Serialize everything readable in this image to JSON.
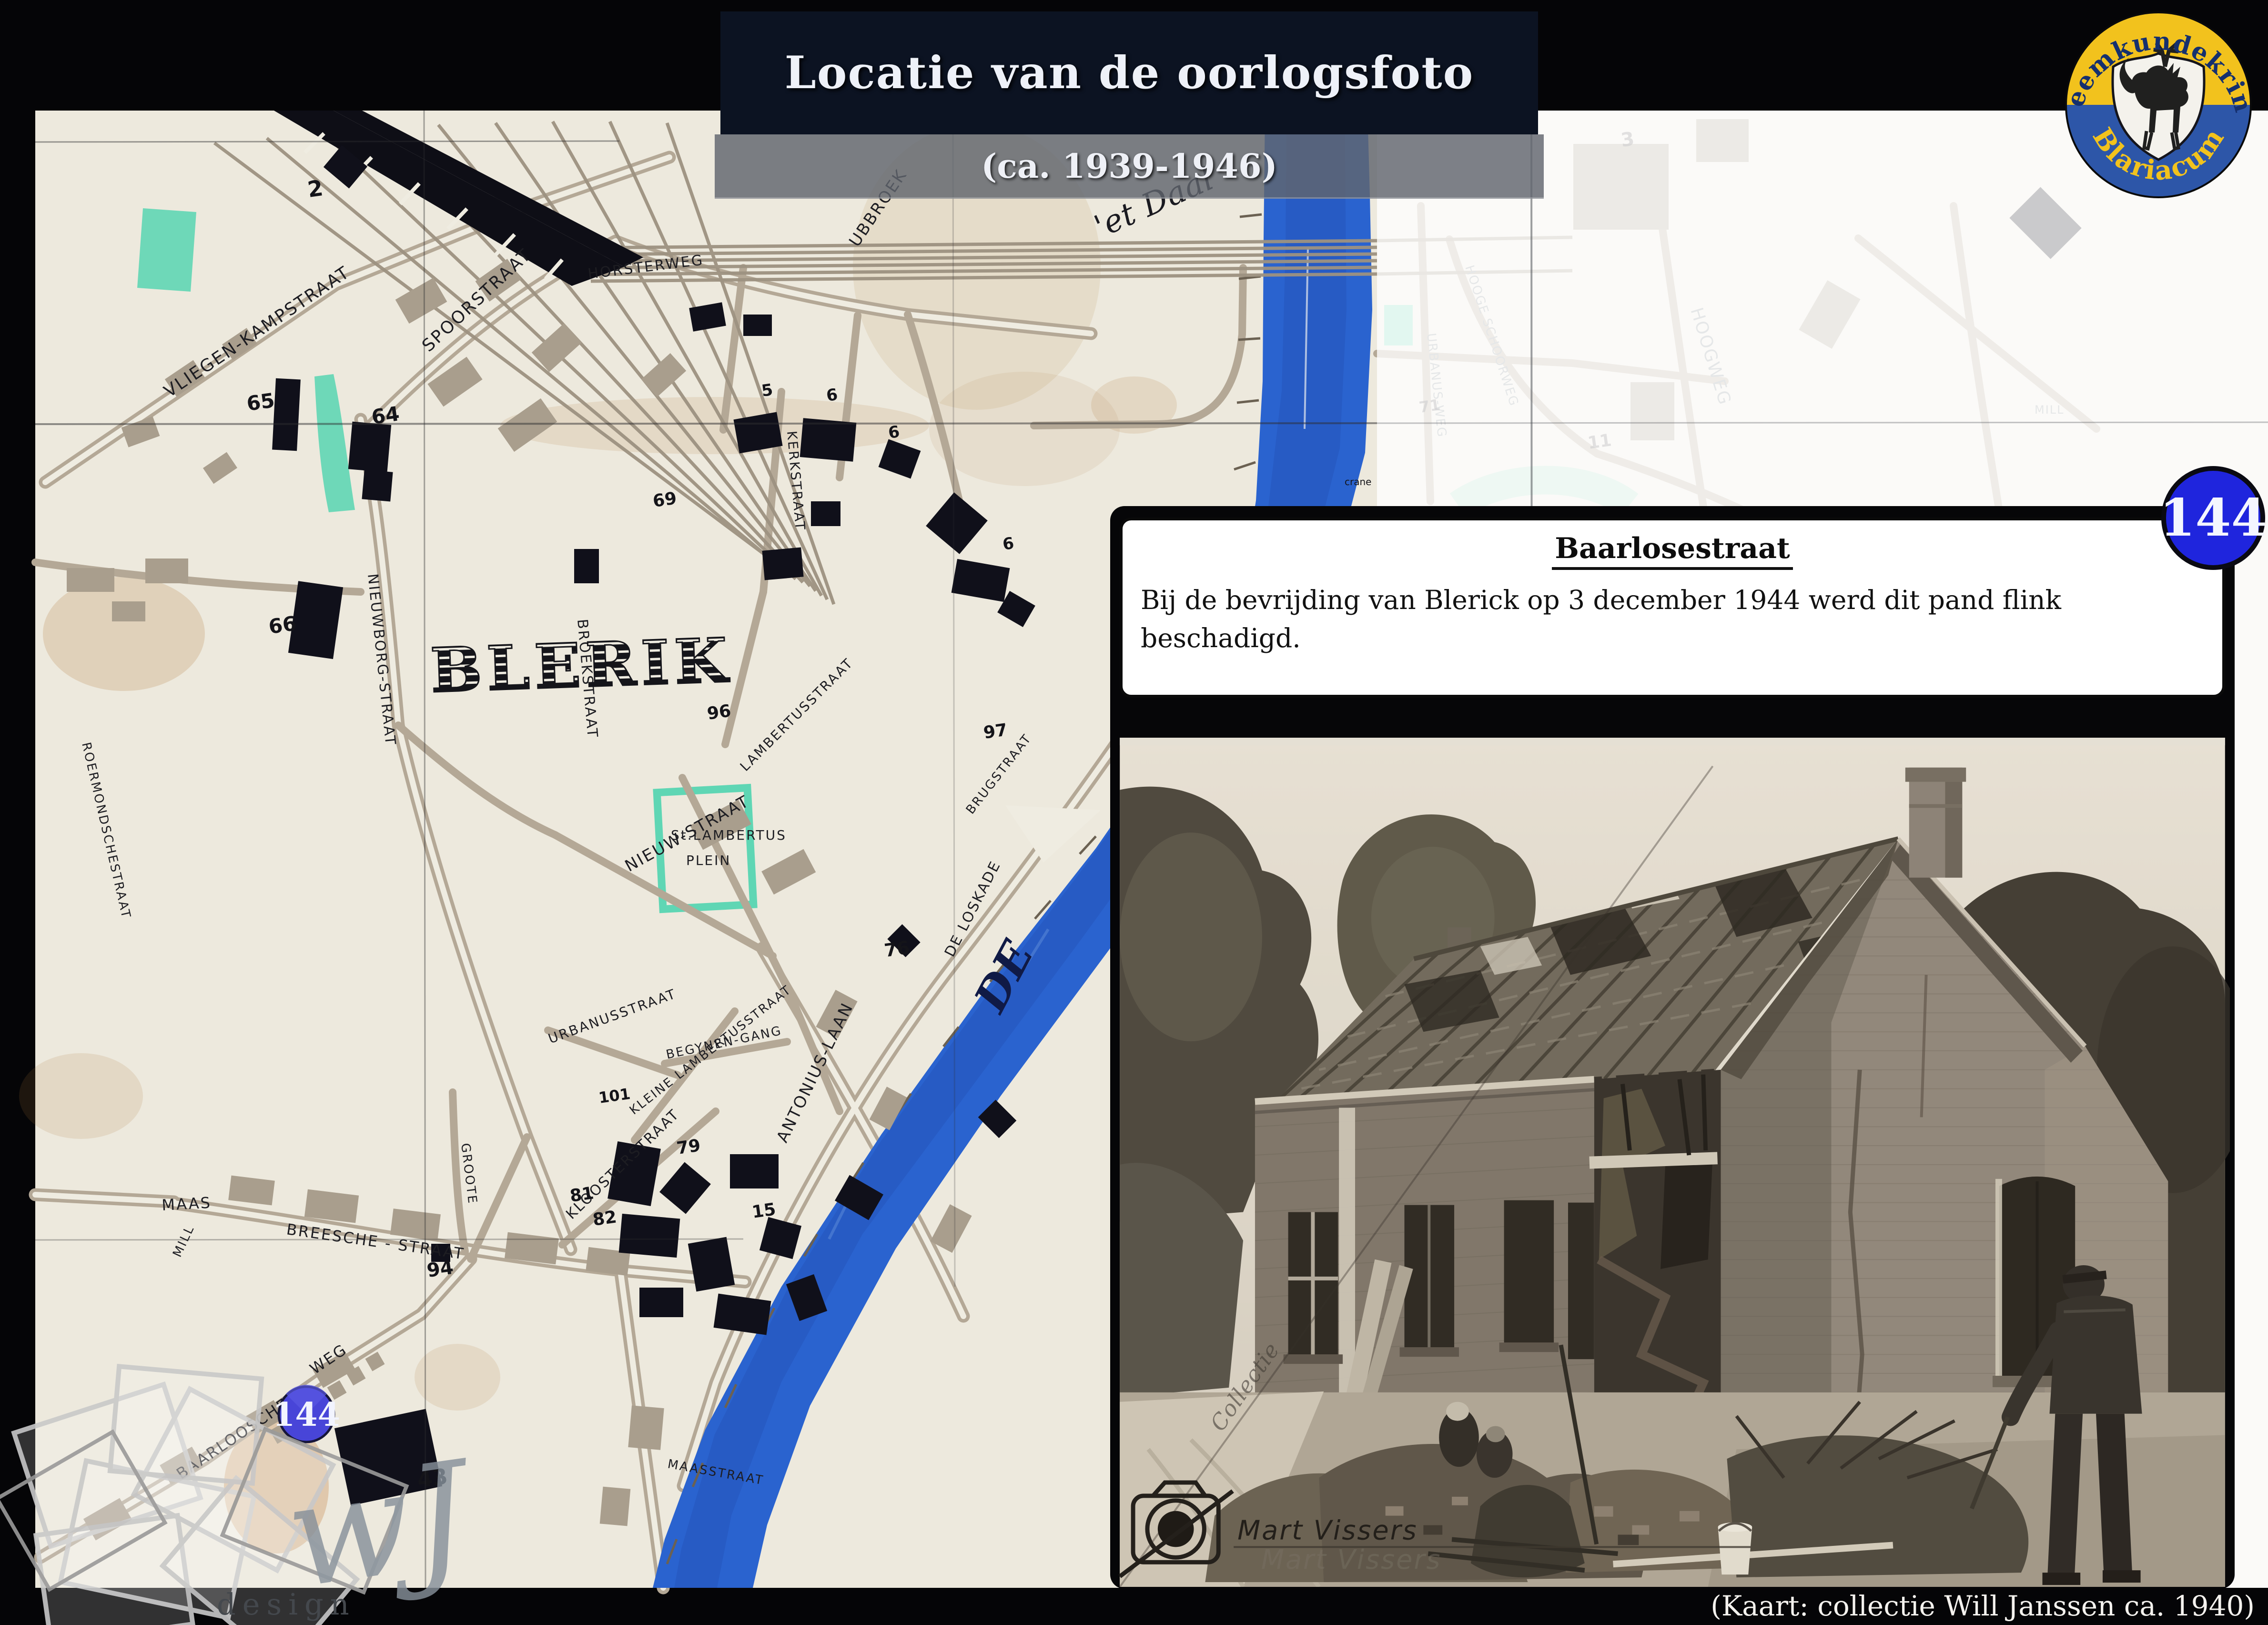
{
  "palette": {
    "slide_bg": "#050507",
    "banner_navy": "#0c1322",
    "subtitle_gray": "#60656e",
    "paper": "#efece1",
    "street_tan": "#b4a896",
    "river_blue": "#2a63cf",
    "teal": "#5fd6b4",
    "badge_blue": "#1f25dd",
    "marker_blue": "#4845d8",
    "logo_yellow": "#f2c21d",
    "logo_blue": "#2d56a8"
  },
  "header": {
    "title": "Locatie van de oorlogsfoto",
    "subtitle": "(ca. 1939-1946)"
  },
  "logo": {
    "top": "Heemkundekring",
    "bottom": "Blariacum"
  },
  "badge": {
    "number": "144"
  },
  "info_box": {
    "title": "Baarlosestraat",
    "body": "Bij de bevrijding van Blerick op 3 december 1944 werd dit pand flink beschadigd."
  },
  "footer": {
    "caption": "(Kaart: collectie Will Janssen ca. 1940)"
  },
  "photo": {
    "credit": "Mart Vissers",
    "credit_shadow": "Mart Vissers",
    "collectie": "Collectie"
  },
  "watermark": {
    "script": "wJ",
    "design": "design"
  },
  "map": {
    "marker": "144",
    "place_label": "BLERIK",
    "labels": [
      {
        "text": "VLIEGEN-KAMPSTRAAT"
      },
      {
        "text": "SPOORSTRAAT"
      },
      {
        "text": "NIEUWBORG-STRAAT"
      },
      {
        "text": "HORSTERWEG"
      },
      {
        "text": "UBBROEK"
      },
      {
        "text": "'et Daal"
      },
      {
        "text": "BROEKSTRAAT"
      },
      {
        "text": "KERKSTRAAT"
      },
      {
        "text": "ROERMONDSCHESTRAAT"
      },
      {
        "text": "NIEUW-STRAAT"
      },
      {
        "text": "St.LAMBERTUS"
      },
      {
        "text": "PLEIN"
      },
      {
        "text": "LAMBERTUSSTRAAT"
      },
      {
        "text": "KLEINE LAMBERTUSSTRAAT"
      },
      {
        "text": "BEGYNEN-GANG"
      },
      {
        "text": "URBANUSSTRAAT"
      },
      {
        "text": "ANTONIUS-LAAN"
      },
      {
        "text": "DE LOSKADE"
      },
      {
        "text": "KLOOSTERSTRAAT"
      },
      {
        "text": "MAAS"
      },
      {
        "text": "MILL"
      },
      {
        "text": "BREESCHE - STRAAT"
      },
      {
        "text": "GROOTE"
      },
      {
        "text": "BAARLOOSCHE"
      },
      {
        "text": "WEG"
      },
      {
        "text": "DE"
      },
      {
        "text": "crane"
      },
      {
        "text": "BRUGSTRAAT"
      },
      {
        "text": "MAASSTRAAT"
      },
      {
        "text": "VILLA-"
      },
      {
        "text": "PARK"
      },
      {
        "text": "HOOGWEG"
      },
      {
        "text": "HOOGE SCHOORWEG"
      },
      {
        "text": "HOOGE BUITENSINGEL"
      },
      {
        "text": "HELBEEK"
      },
      {
        "text": "STRAALSCHE WEG"
      },
      {
        "text": "MILL"
      },
      {
        "text": "URBANUS-WEG"
      }
    ],
    "numbers": [
      {
        "t": "2"
      },
      {
        "t": "65"
      },
      {
        "t": "64"
      },
      {
        "t": "66"
      },
      {
        "t": "69"
      },
      {
        "t": "5"
      },
      {
        "t": "6"
      },
      {
        "t": "6"
      },
      {
        "t": "6"
      },
      {
        "t": "96"
      },
      {
        "t": "97"
      },
      {
        "t": "76"
      },
      {
        "t": "79"
      },
      {
        "t": "15"
      },
      {
        "t": "81"
      },
      {
        "t": "82"
      },
      {
        "t": "101"
      },
      {
        "t": "94"
      },
      {
        "t": "43"
      },
      {
        "t": "3"
      },
      {
        "t": "11"
      },
      {
        "t": "12"
      },
      {
        "t": "71"
      },
      {
        "t": "71"
      }
    ]
  }
}
